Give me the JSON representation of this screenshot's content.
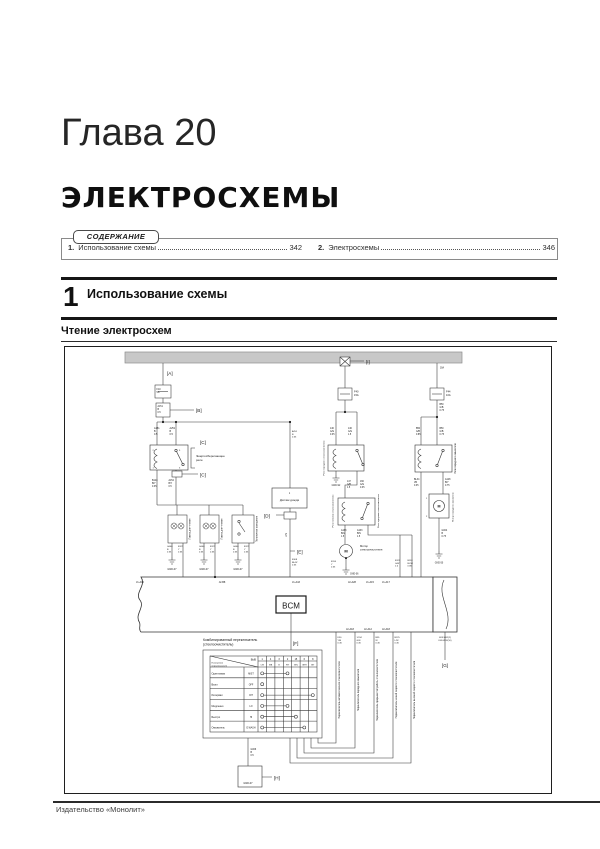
{
  "page": {
    "chapter": "Глава 20",
    "title": "ЭЛЕКТРОСХЕМЫ",
    "footer": "Издательство «Монолит»"
  },
  "contents": {
    "tab_label": "СОДЕРЖАНИЕ",
    "items": [
      {
        "num": "1.",
        "label": "Использование схемы",
        "page": "342"
      },
      {
        "num": "2.",
        "label": "Электросхемы",
        "page": "346"
      }
    ]
  },
  "section": {
    "number": "1",
    "title": "Использование схемы"
  },
  "subsection": {
    "title": "Чтение электросхем"
  },
  "diagram": {
    "labels": [
      {
        "x": 167,
        "y": 375,
        "t": "[A]",
        "s": 4.6
      },
      {
        "x": 196,
        "y": 412,
        "t": "[B]",
        "s": 4.6
      },
      {
        "x": 200,
        "y": 444,
        "t": "[C]",
        "s": 4.6
      },
      {
        "x": 200,
        "y": 476.5,
        "t": "[C]",
        "s": 4.6
      },
      {
        "x": 264,
        "y": 517.5,
        "t": "[D]",
        "s": 4.6
      },
      {
        "x": 297,
        "y": 553.5,
        "t": "[E]",
        "s": 4.6
      },
      {
        "x": 293,
        "y": 645,
        "t": "[F]",
        "s": 4.6
      },
      {
        "x": 445,
        "y": 667,
        "t": "[G]",
        "s": 4.6,
        "a": "middle"
      },
      {
        "x": 274,
        "y": 779.5,
        "t": "[H]",
        "s": 4.6
      },
      {
        "x": 366,
        "y": 363.5,
        "t": "[I]",
        "s": 4.6
      },
      {
        "x": 156.5,
        "y": 390,
        "t": "F10|5A",
        "s": 2.4
      },
      {
        "x": 157.5,
        "y": 407,
        "t": "A151|B|0.5",
        "s": 2.3
      },
      {
        "x": 154,
        "y": 429,
        "t": "A151|B|0.5",
        "s": 2.4
      },
      {
        "x": 169.5,
        "y": 429,
        "t": "A251|B|0.5",
        "s": 2.4
      },
      {
        "x": 152.5,
        "y": 450.8,
        "t": "2",
        "s": 2.2
      },
      {
        "x": 179,
        "y": 450.8,
        "t": "5",
        "s": 2.2
      },
      {
        "x": 152.5,
        "y": 468.5,
        "t": "1",
        "s": 2.2
      },
      {
        "x": 179,
        "y": 468.5,
        "t": "3",
        "s": 2.2
      },
      {
        "x": 196,
        "y": 457,
        "t": "Энергосберегающее|реле",
        "s": 3
      },
      {
        "x": 152,
        "y": 481,
        "t": "B124|B/Y|0.35",
        "s": 2.3
      },
      {
        "x": 168.5,
        "y": 481,
        "t": "A152|B/Y|0.5",
        "s": 2.3
      },
      {
        "x": 190.5,
        "y": 529,
        "t": "Лампа для чтения",
        "s": 2.5,
        "r": -90,
        "a": "middle"
      },
      {
        "x": 222.5,
        "y": 529,
        "t": "Лампа для чтения",
        "s": 2.5,
        "r": -90,
        "a": "middle"
      },
      {
        "x": 257.5,
        "y": 529,
        "t": "Потолочное освещение",
        "s": 2.4,
        "r": -90,
        "a": "middle"
      },
      {
        "x": 167,
        "y": 547,
        "t": "G040|B|0.35",
        "s": 2.2
      },
      {
        "x": 178,
        "y": 547,
        "t": "B127|Y|0.35",
        "s": 2.2
      },
      {
        "x": 199,
        "y": 547,
        "t": "G040|B|0.35",
        "s": 2.2
      },
      {
        "x": 210,
        "y": 547,
        "t": "B127|Y|0.35",
        "s": 2.2
      },
      {
        "x": 233,
        "y": 547,
        "t": "G040|B|0.35",
        "s": 2.2
      },
      {
        "x": 244,
        "y": 547,
        "t": "B127|Y|0.35",
        "s": 2.2
      },
      {
        "x": 172,
        "y": 570,
        "t": "GND-07",
        "s": 2.5,
        "a": "middle"
      },
      {
        "x": 204,
        "y": 570,
        "t": "GND-07",
        "s": 2.5,
        "a": "middle"
      },
      {
        "x": 238,
        "y": 570,
        "t": "GND-07",
        "s": 2.5,
        "a": "middle"
      },
      {
        "x": 292,
        "y": 432,
        "t": "A251|B|0.35",
        "s": 2.2
      },
      {
        "x": 289.5,
        "y": 494,
        "t": "1",
        "s": 2.3,
        "a": "middle"
      },
      {
        "x": 289.5,
        "y": 501,
        "t": "Датчик дождя",
        "s": 3,
        "a": "middle"
      },
      {
        "x": 287,
        "y": 535,
        "t": "LIN",
        "s": 2.5,
        "r": -90,
        "a": "middle"
      },
      {
        "x": 292,
        "y": 560,
        "t": "B108|BL/W|0.35",
        "s": 2.2
      },
      {
        "x": 354,
        "y": 392.5,
        "t": "F40|15A",
        "s": 2.6
      },
      {
        "x": 330,
        "y": 429,
        "t": "146|G/G|0.35",
        "s": 2.3
      },
      {
        "x": 348,
        "y": 429,
        "t": "146|G/G|1.5",
        "s": 2.3
      },
      {
        "x": 324.5,
        "y": 458,
        "t": "Реле переднего стеклоочистителя",
        "s": 2.2,
        "r": -90,
        "a": "middle"
      },
      {
        "x": 336,
        "y": 486,
        "t": "GND-S2",
        "s": 2.3,
        "a": "middle"
      },
      {
        "x": 347,
        "y": 482,
        "t": "147|G/B|1.5",
        "s": 2.3
      },
      {
        "x": 360,
        "y": 482,
        "t": "166|G/G|0.35",
        "s": 2.3
      },
      {
        "x": 333.5,
        "y": 511,
        "t": "Реле питания стеклоочистителя",
        "s": 2.2,
        "r": -90,
        "a": "middle"
      },
      {
        "x": 379,
        "y": 511,
        "t": "Реле задержки стеклоочистителя",
        "s": 2.2,
        "r": -90,
        "a": "middle"
      },
      {
        "x": 341,
        "y": 531,
        "t": "A163|B/G|1.5",
        "s": 2.3
      },
      {
        "x": 357,
        "y": 531,
        "t": "A163|B/N|1.5",
        "s": 2.3
      },
      {
        "x": 346,
        "y": 552.5,
        "t": "M",
        "s": 4,
        "a": "middle",
        "b": 1
      },
      {
        "x": 360,
        "y": 547,
        "t": "Мотор|стеклоочистителя",
        "s": 2.7
      },
      {
        "x": 331,
        "y": 562,
        "t": "B114|Y|0.35",
        "s": 2.2
      },
      {
        "x": 350,
        "y": 574.5,
        "t": "GND-06",
        "s": 2.3
      },
      {
        "x": 395,
        "y": 561,
        "t": "B121|G/W|2.0",
        "s": 2.2
      },
      {
        "x": 407.5,
        "y": 561,
        "t": "B118|BL/W|0.85",
        "s": 2.2
      },
      {
        "x": 440,
        "y": 368.5,
        "t": "30A",
        "s": 2.3
      },
      {
        "x": 446,
        "y": 392.5,
        "t": "F44|10A",
        "s": 2.6
      },
      {
        "x": 439.5,
        "y": 405,
        "t": "B50|G/B|0.75",
        "s": 2.3
      },
      {
        "x": 416,
        "y": 429,
        "t": "B50|G/B|0.85",
        "s": 2.3
      },
      {
        "x": 439.5,
        "y": 429,
        "t": "B50|G/B|0.75",
        "s": 2.3
      },
      {
        "x": 456,
        "y": 458.5,
        "t": "Реле переднего омывателя",
        "s": 2.4,
        "r": -90,
        "a": "middle"
      },
      {
        "x": 414,
        "y": 480,
        "t": "BL34|VR|0.35",
        "s": 2.3
      },
      {
        "x": 445,
        "y": 480,
        "t": "A128|B/Y|0.75",
        "s": 2.3
      },
      {
        "x": 426,
        "y": 499,
        "t": "1",
        "s": 2.2
      },
      {
        "x": 426,
        "y": 517,
        "t": "2",
        "s": 2.2
      },
      {
        "x": 439,
        "y": 507.5,
        "t": "M",
        "s": 3.6,
        "a": "middle",
        "b": 1
      },
      {
        "x": 453.5,
        "y": 507,
        "t": "Мотор переднего омывателя",
        "s": 2.2,
        "r": -90,
        "a": "middle"
      },
      {
        "x": 441.5,
        "y": 531,
        "t": "G004|B|0.75",
        "s": 2.3
      },
      {
        "x": 439,
        "y": 563.5,
        "t": "GND-50",
        "s": 2.3,
        "a": "middle"
      },
      {
        "x": 140,
        "y": 582.8,
        "t": "J1-A02",
        "s": 2.5,
        "a": "middle"
      },
      {
        "x": 222,
        "y": 582.8,
        "t": "J2-B8",
        "s": 2.5,
        "a": "middle"
      },
      {
        "x": 296,
        "y": 582.8,
        "t": "J1-A43",
        "s": 2.5,
        "a": "middle"
      },
      {
        "x": 352,
        "y": 582.8,
        "t": "J2-A28",
        "s": 2.5,
        "a": "middle"
      },
      {
        "x": 370,
        "y": 582.8,
        "t": "J1-A15",
        "s": 2.5,
        "a": "middle"
      },
      {
        "x": 386,
        "y": 582.8,
        "t": "J1-A17",
        "s": 2.5,
        "a": "middle"
      },
      {
        "x": 350,
        "y": 630.2,
        "t": "J2-A18",
        "s": 2.5,
        "a": "middle"
      },
      {
        "x": 368,
        "y": 630.2,
        "t": "J2-A12",
        "s": 2.5,
        "a": "middle"
      },
      {
        "x": 386,
        "y": 630.2,
        "t": "J2-A18",
        "s": 2.5,
        "a": "middle"
      },
      {
        "x": 291,
        "y": 608.5,
        "t": "BCM",
        "s": 8,
        "a": "middle"
      },
      {
        "x": 445,
        "y": 638,
        "t": "K09-W02(2)|K09-W02(10)",
        "s": 2.2,
        "a": "middle"
      },
      {
        "x": 203,
        "y": 641,
        "t": "Комбинированный переключатель|(стеклоочиститель)",
        "s": 3.4
      },
      {
        "x": 256,
        "y": 660.5,
        "t": "ВЫВ",
        "s": 2.4,
        "a": "end"
      },
      {
        "x": 211.5,
        "y": 663.5,
        "t": "Положение|переключателя",
        "s": 2.2
      },
      {
        "x": 262.2,
        "y": 660,
        "t": "1",
        "s": 2.4,
        "a": "middle"
      },
      {
        "x": 270.6,
        "y": 660,
        "t": "4",
        "s": 2.4,
        "a": "middle"
      },
      {
        "x": 279.1,
        "y": 660,
        "t": "3",
        "s": 2.4,
        "a": "middle"
      },
      {
        "x": 287.5,
        "y": 660,
        "t": "2",
        "s": 2.4,
        "a": "middle"
      },
      {
        "x": 295.9,
        "y": 660,
        "t": "15",
        "s": 2.4,
        "a": "middle"
      },
      {
        "x": 304.3,
        "y": 660,
        "t": "6",
        "s": 2.4,
        "a": "middle"
      },
      {
        "x": 312.8,
        "y": 660,
        "t": "8",
        "s": 2.4,
        "a": "middle"
      },
      {
        "x": 262.2,
        "y": 665.5,
        "t": "CW",
        "s": 2,
        "a": "middle"
      },
      {
        "x": 270.6,
        "y": 665.5,
        "t": "N/B",
        "s": 2,
        "a": "middle"
      },
      {
        "x": 279.1,
        "y": 665.5,
        "t": "B",
        "s": 2,
        "a": "middle"
      },
      {
        "x": 287.5,
        "y": 665.5,
        "t": "H/Y",
        "s": 2,
        "a": "middle"
      },
      {
        "x": 295.9,
        "y": 665.5,
        "t": "GHL",
        "s": 2,
        "a": "middle"
      },
      {
        "x": 304.3,
        "y": 665.5,
        "t": "GRH",
        "s": 2,
        "a": "middle"
      },
      {
        "x": 312.8,
        "y": 665.5,
        "t": "INT",
        "s": 2,
        "a": "middle"
      },
      {
        "x": 211.5,
        "y": 674.5,
        "t": "Один взмах",
        "s": 2.5
      },
      {
        "x": 211.5,
        "y": 685.3,
        "t": "Выкл",
        "s": 2.5
      },
      {
        "x": 211.5,
        "y": 696.1,
        "t": "Интервал",
        "s": 2.5
      },
      {
        "x": 211.5,
        "y": 707,
        "t": "Медленно",
        "s": 2.5
      },
      {
        "x": 211.5,
        "y": 717.8,
        "t": "Быстро",
        "s": 2.5
      },
      {
        "x": 211.5,
        "y": 728.6,
        "t": "Омыватель",
        "s": 2.5
      },
      {
        "x": 251,
        "y": 674.5,
        "t": "MIST",
        "s": 2.3,
        "a": "middle"
      },
      {
        "x": 251,
        "y": 685.3,
        "t": "OFF",
        "s": 2.3,
        "a": "middle"
      },
      {
        "x": 251,
        "y": 696.1,
        "t": "INT",
        "s": 2.3,
        "a": "middle"
      },
      {
        "x": 251,
        "y": 707,
        "t": "LO",
        "s": 2.3,
        "a": "middle"
      },
      {
        "x": 251,
        "y": 717.8,
        "t": "HI",
        "s": 2.3,
        "a": "middle"
      },
      {
        "x": 251,
        "y": 728.6,
        "t": "E.WASH",
        "s": 2.3,
        "a": "middle"
      },
      {
        "x": 337.5,
        "y": 638,
        "t": "K30|Y/B|0.35",
        "s": 2.2
      },
      {
        "x": 356.5,
        "y": 638,
        "t": "1C34|G/N|0.35",
        "s": 2.2
      },
      {
        "x": 375.5,
        "y": 638,
        "t": "B35|W|0.35",
        "s": 2.2
      },
      {
        "x": 394.5,
        "y": 638,
        "t": "B125|L/W|0.35",
        "s": 2.2
      },
      {
        "x": 340,
        "y": 690,
        "t": "Переключатель автоматического стеклоочистителя",
        "s": 2.4,
        "r": -90,
        "a": "middle"
      },
      {
        "x": 359,
        "y": 690,
        "t": "Переключатель переднего омывателя",
        "s": 2.4,
        "r": -90,
        "a": "middle"
      },
      {
        "x": 378,
        "y": 690,
        "t": "Переключатель прерывистой работы стеклоочистителя",
        "s": 2.4,
        "r": -90,
        "a": "middle"
      },
      {
        "x": 397,
        "y": 690,
        "t": "Переключатель низкой скорости стеклоочистителя",
        "s": 2.4,
        "r": -90,
        "a": "middle"
      },
      {
        "x": 415,
        "y": 690,
        "t": "Переключатель высокой скорости стеклоочистителя",
        "s": 2.4,
        "r": -90,
        "a": "middle"
      },
      {
        "x": 250.5,
        "y": 750,
        "t": "G006|B|0.5",
        "s": 2.3
      },
      {
        "x": 248,
        "y": 784,
        "t": "GND-07",
        "s": 2.5,
        "a": "middle"
      }
    ]
  }
}
